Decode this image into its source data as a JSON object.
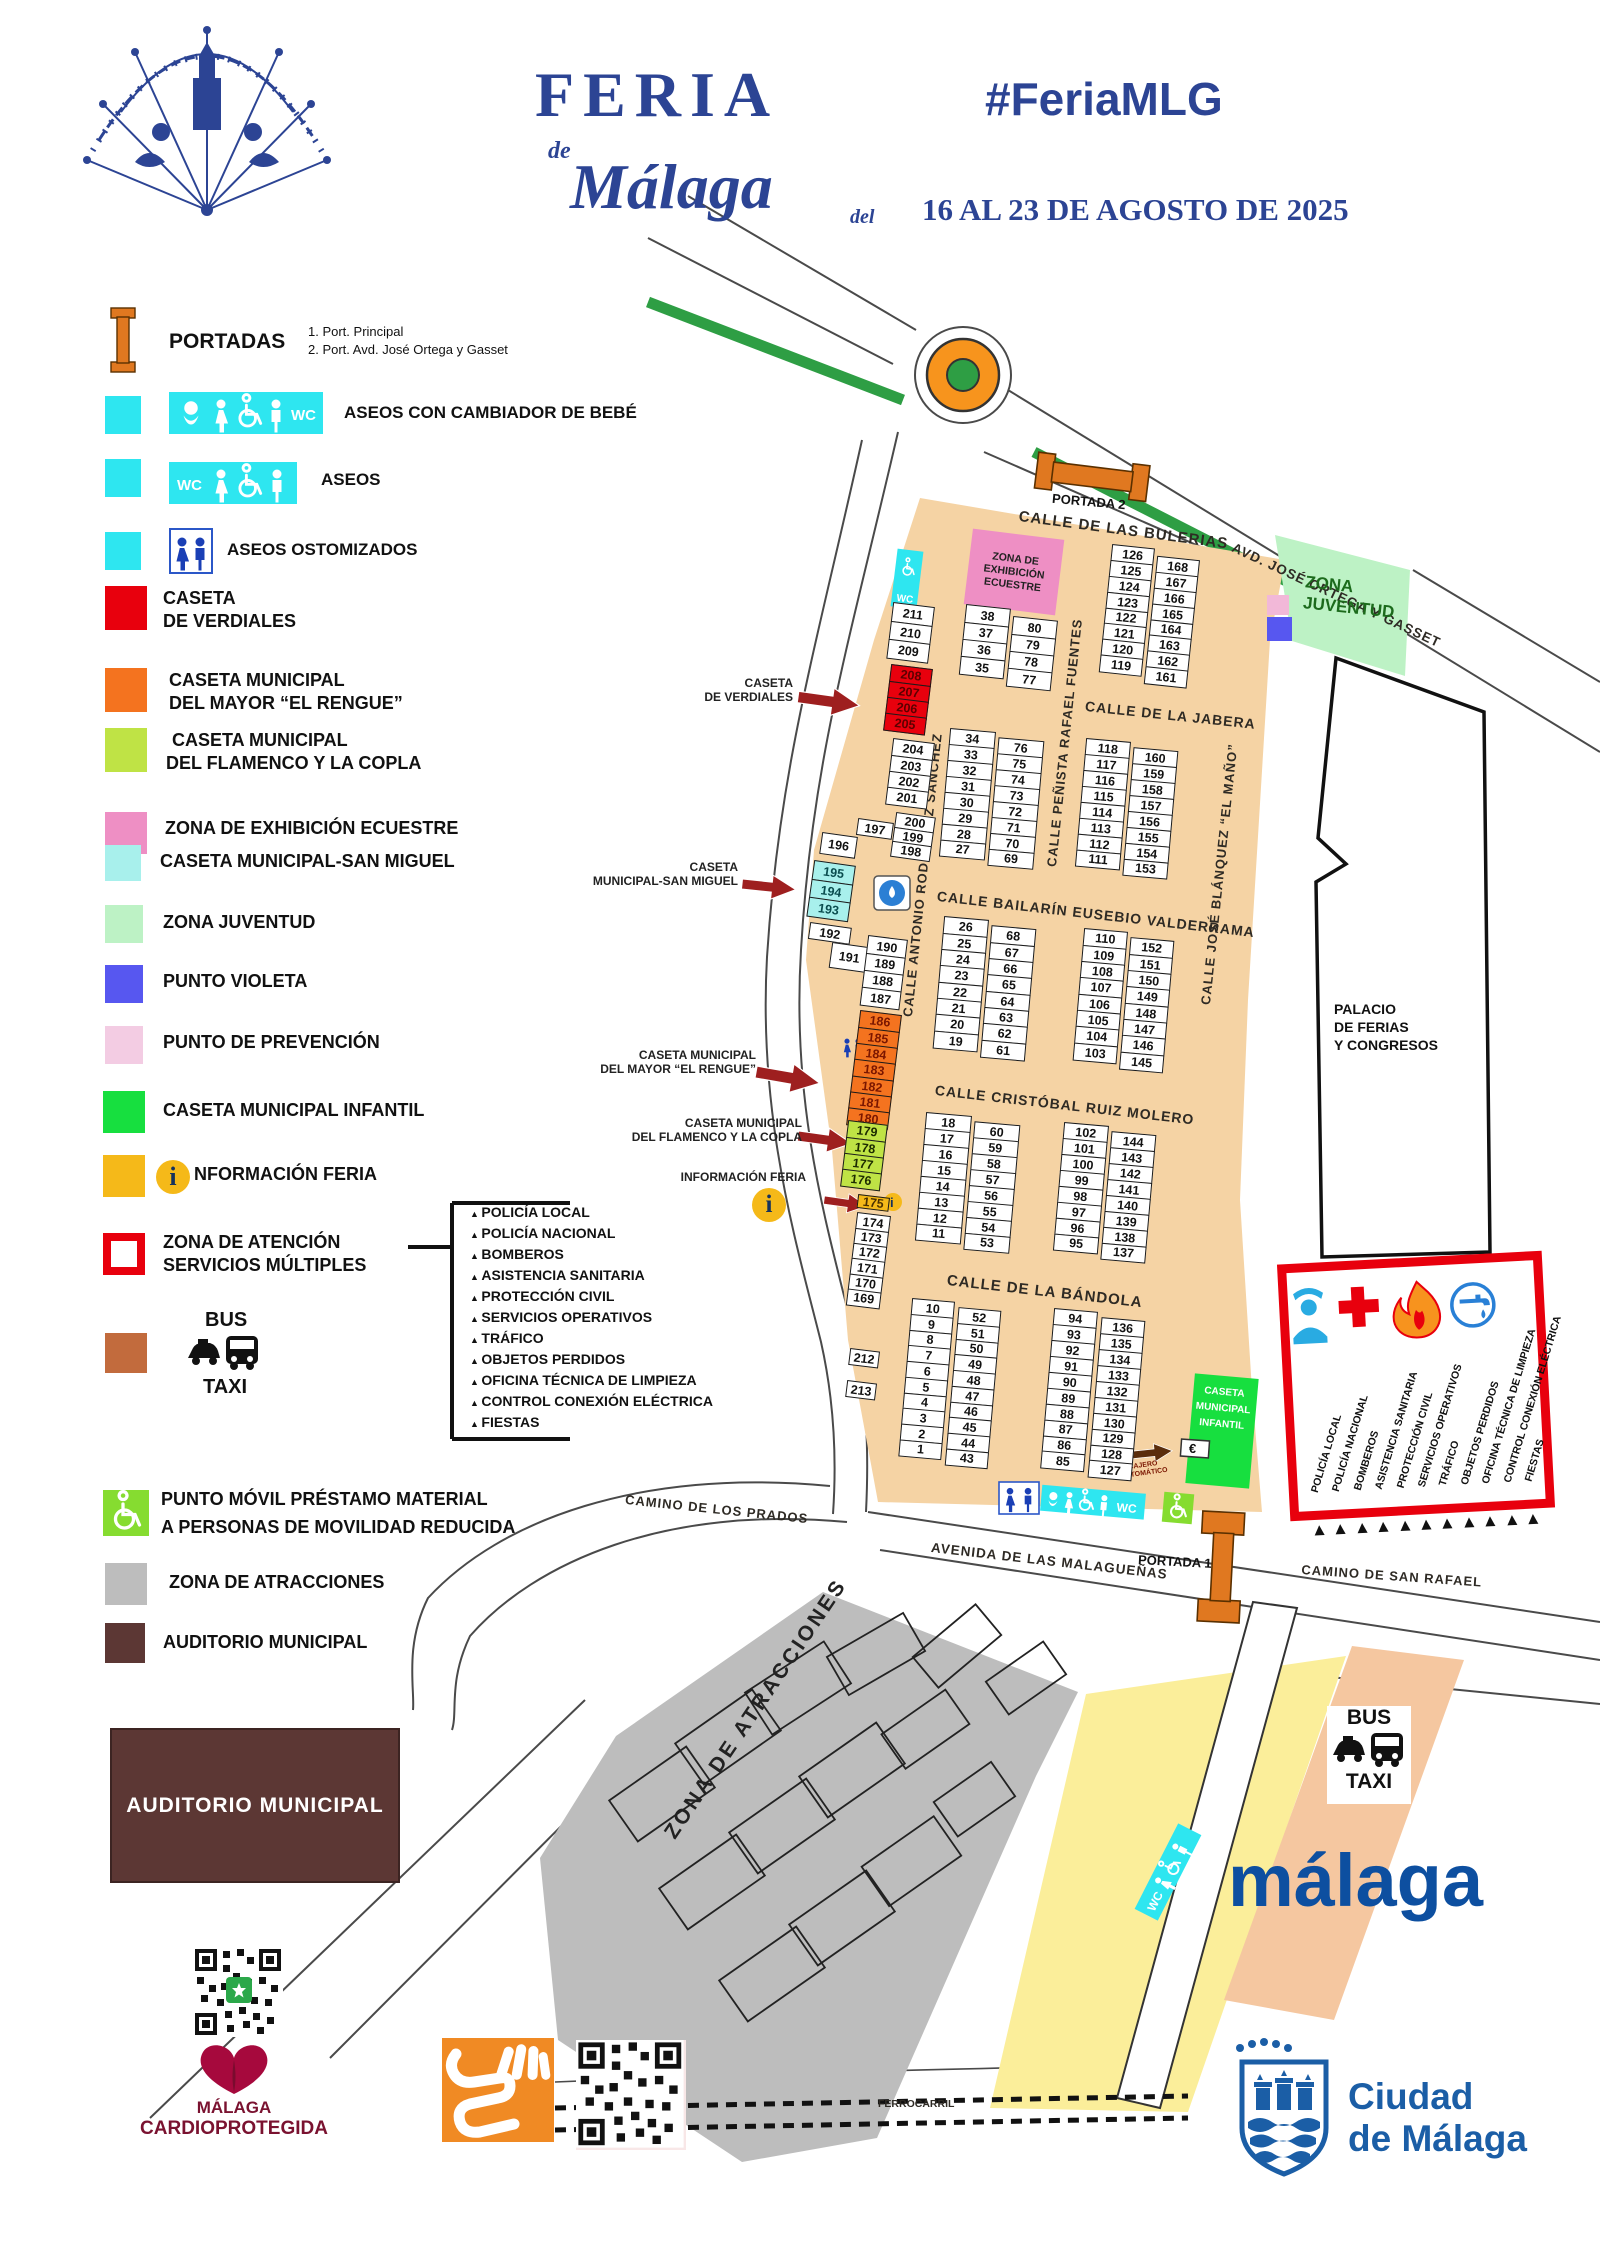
{
  "header": {
    "logo": "feria-fan-logo",
    "title": "FERIA",
    "title_de": "de",
    "title_city": "Málaga",
    "hashtag": "#FeriaMLG",
    "dates_prefix": "del",
    "dates": "16 AL 23 DE AGOSTO DE 2025",
    "brand_color": "#2C4494"
  },
  "legend": {
    "portadas": {
      "label": "PORTADAS",
      "items": [
        "1. Port. Principal",
        "2. Port. Avd. José Ortega y Gasset"
      ]
    },
    "rows": [
      {
        "color": "#2EE6F0",
        "line1": "ASEOS CON CAMBIADOR DE BEBÉ",
        "line2": ""
      },
      {
        "color": "#2EE6F0",
        "line1": "ASEOS",
        "line2": ""
      },
      {
        "color": "#2EE6F0",
        "line1": "ASEOS OSTOMIZADOS",
        "line2": ""
      },
      {
        "color": "#E8000D",
        "line1": "CASETA",
        "line2": "DE VERDIALES"
      },
      {
        "color": "#F4731F",
        "line1": "CASETA MUNICIPAL",
        "line2": "DEL MAYOR “EL RENGUE”"
      },
      {
        "color": "#BFE345",
        "line1": "CASETA MUNICIPAL",
        "line2": "DEL FLAMENCO Y LA COPLA"
      },
      {
        "color": "#EE8FC4",
        "line1": "ZONA DE EXHIBICIÓN ECUESTRE",
        "line2": ""
      },
      {
        "color": "#A8F0EC",
        "line1": "CASETA MUNICIPAL-SAN MIGUEL",
        "line2": ""
      },
      {
        "color": "#BDF2C5",
        "line1": "ZONA JUVENTUD",
        "line2": ""
      },
      {
        "color": "#5757F0",
        "line1": "PUNTO VIOLETA",
        "line2": ""
      },
      {
        "color": "#F3CCE3",
        "line1": "PUNTO DE PREVENCIÓN",
        "line2": ""
      },
      {
        "color": "#17DF3F",
        "line1": "CASETA MUNICIPAL INFANTIL",
        "line2": ""
      },
      {
        "color": "#F5B919",
        "line1": "NFORMACIÓN FERIA",
        "line2": ""
      },
      {
        "color": "#E8000D",
        "line1": "ZONA DE ATENCIÓN",
        "line2": "SERVICIOS MÚLTIPLES"
      },
      {
        "color": "#C26B3D",
        "line1": "BUS",
        "line2": "TAXI"
      },
      {
        "color": "#86DC30",
        "line1": "PUNTO MÓVIL PRÉSTAMO MATERIAL",
        "line2": "A PERSONAS DE MOVILIDAD REDUCIDA"
      },
      {
        "color": "#BDBDBD",
        "line1": "ZONA DE ATRACCIONES",
        "line2": ""
      },
      {
        "color": "#5C3734",
        "line1": "AUDITORIO MUNICIPAL",
        "line2": ""
      }
    ]
  },
  "services": {
    "items": [
      "POLICÍA LOCAL",
      "POLICÍA NACIONAL",
      "BOMBEROS",
      "ASISTENCIA SANITARIA",
      "PROTECCIÓN CIVIL",
      "SERVICIOS OPERATIVOS",
      "TRÁFICO",
      "OBJETOS PERDIDOS",
      "OFICINA TÉCNICA DE LIMPIEZA",
      "CONTROL CONEXIÓN ELÉCTRICA",
      "FIESTAS"
    ]
  },
  "map": {
    "streets": [
      {
        "label": "CALLE DE LAS BULERIAS"
      },
      {
        "label": "CALLE DE LA JABERA"
      },
      {
        "label": "CALLE BAILARÍN EUSEBIO VALDERRAMA"
      },
      {
        "label": "CALLE CRISTÓBAL RUIZ MOLERO"
      },
      {
        "label": "CALLE DE LA BÁNDOLA"
      },
      {
        "label": "CALLE PEÑISTA RAFAEL FUENTES"
      },
      {
        "label": "CALLE ANTONIO RODRÍGUEZ SÁNCHEZ"
      },
      {
        "label": "CALLE JOSÉ BLÁNQUEZ “EL MAÑO”"
      },
      {
        "label": "AVD. JOSÉ ORTEGA Y GASSET"
      },
      {
        "label": "CAMINO DE LOS PRADOS"
      },
      {
        "label": "AVENIDA DE LAS MALAGUEÑAS"
      },
      {
        "label": "CAMINO DE SAN RAFAEL"
      },
      {
        "label": "FERROCARRIL"
      }
    ],
    "zones": {
      "ecuestre": {
        "line1": "ZONA DE",
        "line2": "EXHIBICIÓN",
        "line3": "ECUESTRE"
      },
      "juventud": {
        "line1": "ZONA",
        "line2": "JUVENTUD"
      },
      "infantil": {
        "line1": "CASETA",
        "line2": "MUNICIPAL",
        "line3": "INFANTIL"
      },
      "palacio": {
        "line1": "PALACIO",
        "line2": "DE FERIAS",
        "line3": "Y CONGRESOS"
      },
      "atracciones": {
        "label": "ZONA DE ATRACCIONES"
      }
    },
    "portada1": "PORTADA 1",
    "portada2": "PORTADA 2",
    "bus_taxi": {
      "bus": "BUS",
      "taxi": "TAXI"
    },
    "wc_text": "WC",
    "info_i": "i",
    "cajero": {
      "symbol": "€",
      "line1": "CAJERO",
      "line2": "AUTOMÁTICO"
    },
    "callouts": [
      {
        "line1": "CASETA",
        "line2": "DE VERDIALES"
      },
      {
        "line1": "CASETA",
        "line2": "MUNICIPAL-SAN MIGUEL"
      },
      {
        "line1": "CASETA MUNICIPAL",
        "line2": "DEL MAYOR “EL RENGUE”"
      },
      {
        "line1": "CASETA MUNICIPAL",
        "line2": "DEL FLAMENCO Y LA COPLA"
      },
      {
        "line1": "INFORMACIÓN FERIA",
        "line2": ""
      }
    ],
    "block_groups": [
      {
        "x": 893,
        "y": 604,
        "rot": 7,
        "cw": 42,
        "ch": 20,
        "cols": [
          [
            "211",
            "210",
            "209"
          ]
        ]
      },
      {
        "x": 891,
        "y": 666,
        "rot": 7,
        "cw": 42,
        "ch": 18,
        "fill": "#E8000D",
        "text": "#5c0000",
        "cols": [
          [
            "208",
            "207",
            "206",
            "205"
          ]
        ]
      },
      {
        "x": 893,
        "y": 740,
        "rot": 7,
        "cw": 42,
        "ch": 18,
        "cols": [
          [
            "204",
            "203",
            "202",
            "201"
          ]
        ]
      },
      {
        "x": 896,
        "y": 814,
        "rot": 8,
        "cw": 40,
        "ch": 16,
        "cols": [
          [
            "200",
            "199",
            "198"
          ]
        ]
      },
      {
        "x": 858,
        "y": 820,
        "rot": 8,
        "cw": 36,
        "ch": 17,
        "cols": [
          [
            "197"
          ]
        ]
      },
      {
        "x": 822,
        "y": 834,
        "rot": 8,
        "cw": 36,
        "ch": 22,
        "cols": [
          [
            "196"
          ]
        ]
      },
      {
        "x": 814,
        "y": 862,
        "rot": 8,
        "cw": 42,
        "ch": 20,
        "fill": "#A8F0EC",
        "text": "#0a4d4f",
        "cols": [
          [
            "195",
            "194",
            "193"
          ]
        ]
      },
      {
        "x": 810,
        "y": 924,
        "rot": 8,
        "cw": 42,
        "ch": 17,
        "cols": [
          [
            "192"
          ]
        ]
      },
      {
        "x": 832,
        "y": 944,
        "rot": 8,
        "cw": 38,
        "ch": 26,
        "cols": [
          [
            "191"
          ]
        ]
      },
      {
        "x": 868,
        "y": 937,
        "rot": 7,
        "cw": 40,
        "ch": 19,
        "cols": [
          [
            "190",
            "189",
            "188",
            "187"
          ]
        ]
      },
      {
        "x": 860,
        "y": 1012,
        "rot": 7,
        "cw": 42,
        "ch": 18,
        "fill": "#F4731F",
        "text": "#7a1600",
        "cols": [
          [
            "186",
            "185",
            "184",
            "183",
            "182",
            "181",
            "180"
          ]
        ]
      },
      {
        "x": 848,
        "y": 1122,
        "rot": 7,
        "cw": 40,
        "ch": 18,
        "fill": "#BFE345",
        "text": "#1c2b00",
        "cols": [
          [
            "179",
            "178",
            "177",
            "176"
          ]
        ]
      },
      {
        "x": 858,
        "y": 1196,
        "rot": 7,
        "cw": 32,
        "ch": 14,
        "fill": "#F5B919",
        "text": "#4a3000",
        "cols": [
          [
            "175"
          ]
        ]
      },
      {
        "x": 857,
        "y": 1214,
        "rot": 7,
        "cw": 34,
        "ch": 17,
        "cols": [
          [
            "174",
            "173",
            "172",
            "171",
            "170",
            "169"
          ]
        ]
      },
      {
        "x": 850,
        "y": 1350,
        "rot": 7,
        "cw": 30,
        "ch": 17,
        "cols": [
          [
            "212"
          ]
        ]
      },
      {
        "x": 847,
        "y": 1382,
        "rot": 7,
        "cw": 30,
        "ch": 17,
        "cols": [
          [
            "213"
          ]
        ]
      },
      {
        "x": 966,
        "y": 606,
        "rot": 6,
        "cw": 45,
        "ch": 19,
        "gap": 3,
        "dy": 7,
        "cols": [
          [
            "38",
            "37",
            "36",
            "35"
          ],
          [
            "80",
            "79",
            "78",
            "77"
          ]
        ]
      },
      {
        "x": 1112,
        "y": 546,
        "rot": 6,
        "cw": 43,
        "ch": 17.5,
        "gap": 3,
        "dy": 7,
        "cols": [
          [
            "126",
            "125",
            "124",
            "123",
            "122",
            "121",
            "120",
            "119"
          ],
          [
            "168",
            "167",
            "166",
            "165",
            "164",
            "163",
            "162",
            "161"
          ]
        ]
      },
      {
        "x": 950,
        "y": 730,
        "rot": 5,
        "cw": 46,
        "ch": 17.6,
        "gap": 3,
        "dy": 5,
        "cols": [
          [
            "34",
            "33",
            "32",
            "31",
            "30",
            "29",
            "28",
            "27"
          ],
          [
            "76",
            "75",
            "74",
            "73",
            "72",
            "71",
            "70",
            "69"
          ]
        ]
      },
      {
        "x": 1086,
        "y": 740,
        "rot": 5,
        "cw": 45,
        "ch": 17.6,
        "gap": 3,
        "dy": 5,
        "cols": [
          [
            "118",
            "117",
            "116",
            "115",
            "114",
            "113",
            "112",
            "111"
          ],
          [
            "160",
            "159",
            "158",
            "157",
            "156",
            "155",
            "154",
            "153"
          ]
        ]
      },
      {
        "x": 944,
        "y": 918,
        "rot": 5,
        "cw": 45,
        "ch": 18,
        "gap": 3,
        "dy": 5,
        "cols": [
          [
            "26",
            "25",
            "24",
            "23",
            "22",
            "21",
            "20",
            "19"
          ],
          [
            "68",
            "67",
            "66",
            "65",
            "64",
            "63",
            "62",
            "61"
          ]
        ]
      },
      {
        "x": 1084,
        "y": 930,
        "rot": 5,
        "cw": 44,
        "ch": 18,
        "gap": 3,
        "dy": 5,
        "cols": [
          [
            "110",
            "109",
            "108",
            "107",
            "106",
            "105",
            "104",
            "103"
          ],
          [
            "152",
            "151",
            "150",
            "149",
            "148",
            "147",
            "146",
            "145"
          ]
        ]
      },
      {
        "x": 926,
        "y": 1114,
        "rot": 5,
        "cw": 46,
        "ch": 17.6,
        "gap": 3,
        "dy": 5,
        "cols": [
          [
            "18",
            "17",
            "16",
            "15",
            "14",
            "13",
            "12",
            "11"
          ],
          [
            "60",
            "59",
            "58",
            "57",
            "56",
            "55",
            "54",
            "53"
          ]
        ]
      },
      {
        "x": 1064,
        "y": 1124,
        "rot": 5,
        "cw": 45,
        "ch": 17.6,
        "gap": 3,
        "dy": 5,
        "cols": [
          [
            "102",
            "101",
            "100",
            "99",
            "98",
            "97",
            "96",
            "95"
          ],
          [
            "144",
            "143",
            "142",
            "141",
            "140",
            "139",
            "138",
            "137"
          ]
        ]
      },
      {
        "x": 912,
        "y": 1300,
        "rot": 5,
        "cw": 43,
        "ch": 17.4,
        "gap": 4,
        "dy": 5,
        "cols": [
          [
            "10",
            "9",
            "8",
            "7",
            "6",
            "5",
            "4",
            "3",
            "2",
            "1"
          ],
          [
            "52",
            "51",
            "50",
            "49",
            "48",
            "47",
            "46",
            "45",
            "44",
            "43"
          ]
        ]
      },
      {
        "x": 1054,
        "y": 1310,
        "rot": 5,
        "cw": 44,
        "ch": 17.6,
        "gap": 4,
        "dy": 5,
        "cols": [
          [
            "94",
            "93",
            "92",
            "91",
            "90",
            "89",
            "88",
            "87",
            "86",
            "85"
          ],
          [
            "136",
            "135",
            "134",
            "133",
            "132",
            "131",
            "130",
            "129",
            "128",
            "127"
          ]
        ]
      }
    ]
  },
  "footer": {
    "malaga_logo": "málaga",
    "ciudad": {
      "line1": "Ciudad",
      "line2": "de Málaga"
    },
    "cardio": {
      "line1": "MÁLAGA",
      "line2": "CARDIOPROTEGIDA"
    }
  }
}
